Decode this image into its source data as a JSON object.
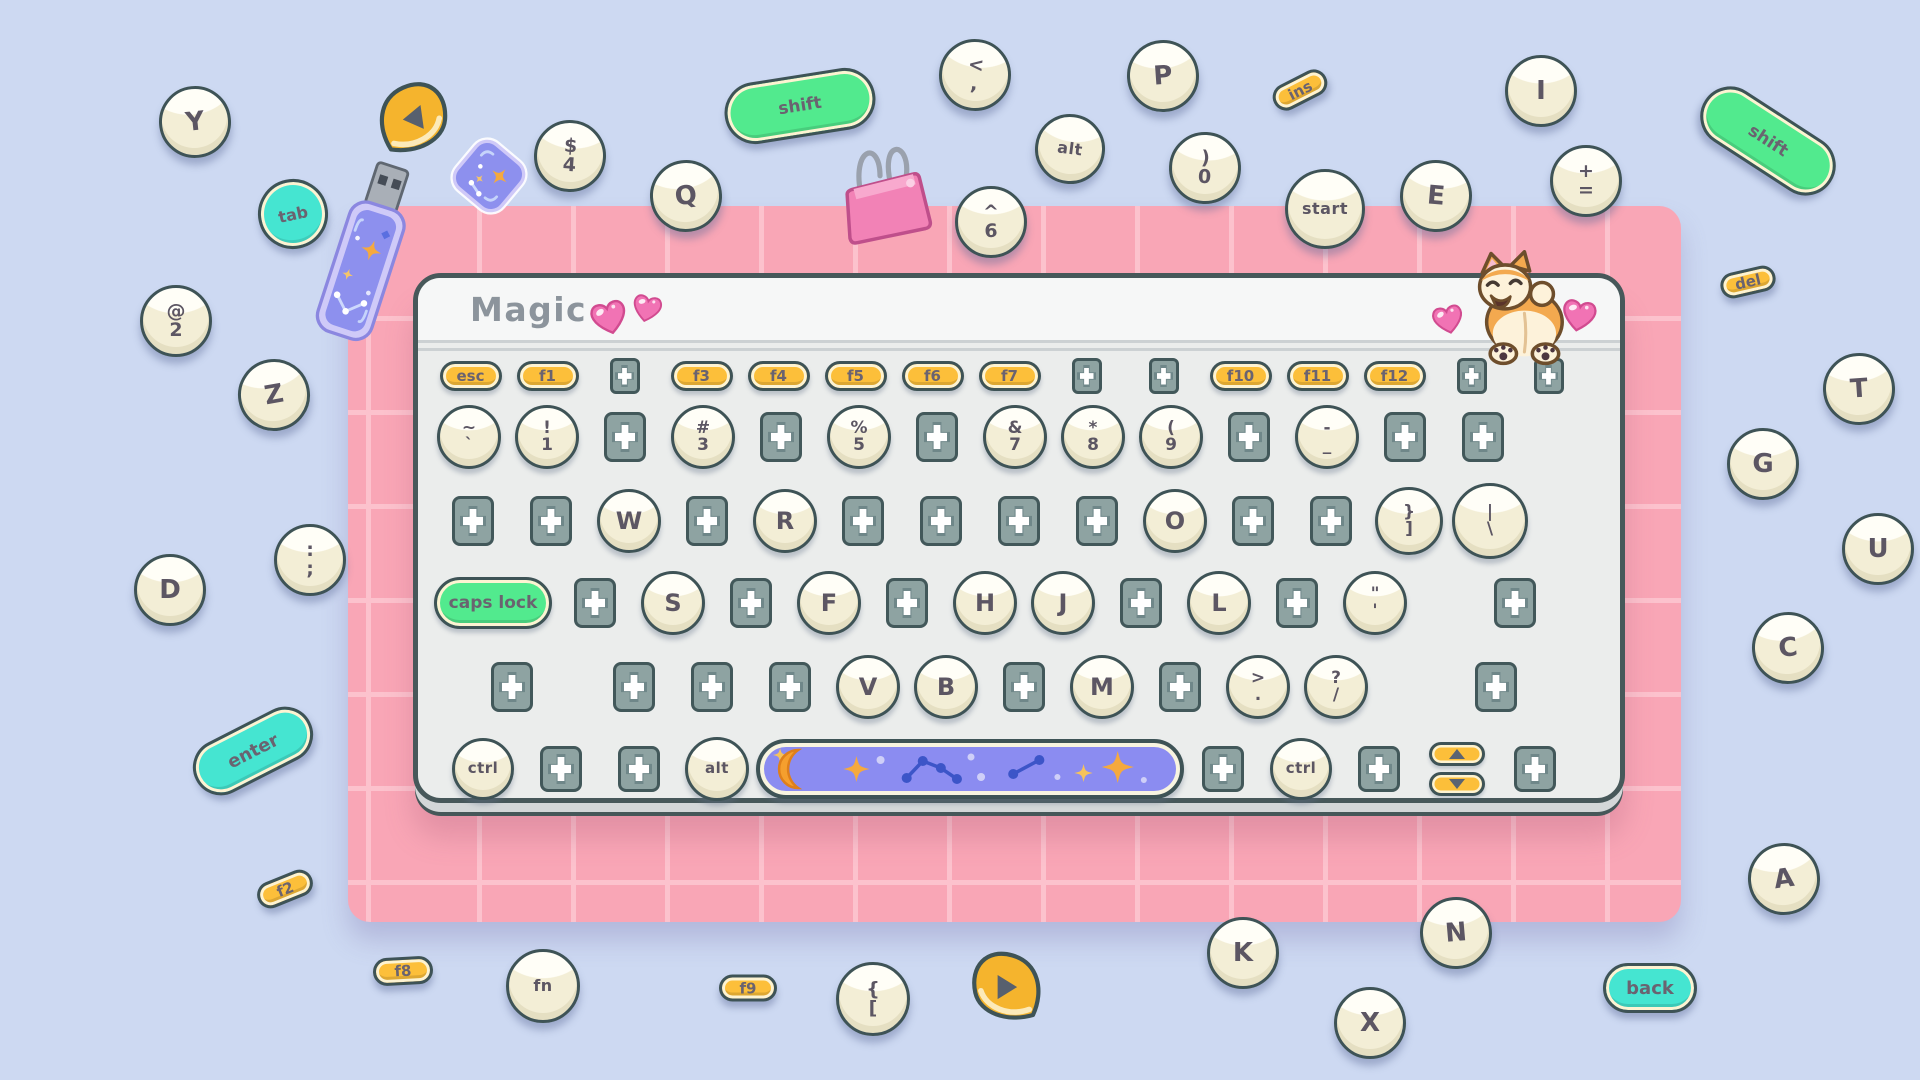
{
  "theme": {
    "background": "#cdd9f2",
    "mat": "#f9a6b6",
    "mat_grid": "#fcc2cd",
    "keyboard_body": "#ebedec",
    "keyboard_header": "#f6f7f7",
    "keyboard_border": "#47585a",
    "key_cream": "#fdfbee",
    "key_text": "#5c5663",
    "slot_fill": "#8ea3a2",
    "slot_border": "#42585a",
    "accent_yellow": "#fcbf3a",
    "accent_green": "#52ea8e",
    "accent_teal": "#45e5d1",
    "space_purple": "#8b8cf1",
    "heart_pink": "#f173b4",
    "corgi_orange": "#f3a94f"
  },
  "keyboard": {
    "title": "Magic",
    "rows": [
      {
        "name": "function",
        "top": 80,
        "left": 14,
        "cell": 77,
        "h": 36,
        "items": [
          {
            "k": "fpill",
            "l": "esc"
          },
          {
            "k": "fpill",
            "l": "f1"
          },
          {
            "k": "slot",
            "v": "sm"
          },
          {
            "k": "fpill",
            "l": "f3"
          },
          {
            "k": "fpill",
            "l": "f4"
          },
          {
            "k": "fpill",
            "l": "f5"
          },
          {
            "k": "fpill",
            "l": "f6"
          },
          {
            "k": "fpill",
            "l": "f7"
          },
          {
            "k": "slot",
            "v": "sm"
          },
          {
            "k": "slot",
            "v": "sm"
          },
          {
            "k": "fpill",
            "l": "f10"
          },
          {
            "k": "fpill",
            "l": "f11"
          },
          {
            "k": "fpill",
            "l": "f12"
          },
          {
            "k": "slot",
            "v": "sm"
          },
          {
            "k": "slot",
            "v": "sm"
          }
        ]
      },
      {
        "name": "number",
        "top": 124,
        "left": 12,
        "cell": 78,
        "h": 70,
        "items": [
          {
            "k": "key2",
            "l": "~",
            "l2": "`"
          },
          {
            "k": "key2",
            "l": "!",
            "l2": "1"
          },
          {
            "k": "slot"
          },
          {
            "k": "key2",
            "l": "#",
            "l2": "3"
          },
          {
            "k": "slot"
          },
          {
            "k": "key2",
            "l": "%",
            "l2": "5"
          },
          {
            "k": "slot"
          },
          {
            "k": "key2",
            "l": "&",
            "l2": "7"
          },
          {
            "k": "key2",
            "l": "*",
            "l2": "8"
          },
          {
            "k": "key2",
            "l": "(",
            "l2": "9"
          },
          {
            "k": "slot"
          },
          {
            "k": "key2",
            "l": "-",
            "l2": "_"
          },
          {
            "k": "slot"
          },
          {
            "k": "slot"
          }
        ]
      },
      {
        "name": "upper",
        "top": 207,
        "left": 16,
        "cell": 78,
        "h": 72,
        "items": [
          {
            "k": "slot"
          },
          {
            "k": "slot"
          },
          {
            "k": "key",
            "l": "W"
          },
          {
            "k": "slot"
          },
          {
            "k": "key",
            "l": "R"
          },
          {
            "k": "slot"
          },
          {
            "k": "slot"
          },
          {
            "k": "slot"
          },
          {
            "k": "slot"
          },
          {
            "k": "key",
            "l": "O"
          },
          {
            "k": "slot"
          },
          {
            "k": "slot"
          },
          {
            "k": "key2",
            "l": "}",
            "l2": "]",
            "size": 68
          },
          {
            "k": "key2",
            "l": "|",
            "l2": "\\",
            "w": 84,
            "size": 76
          }
        ]
      },
      {
        "name": "home",
        "top": 289,
        "left": 12,
        "cell": 78,
        "h": 72,
        "items": [
          {
            "k": "gpill",
            "l": "caps lock",
            "w": 126,
            "pw": 118,
            "ph": 52
          },
          {
            "k": "slot"
          },
          {
            "k": "key",
            "l": "S"
          },
          {
            "k": "slot"
          },
          {
            "k": "key",
            "l": "F"
          },
          {
            "k": "slot"
          },
          {
            "k": "key",
            "l": "H"
          },
          {
            "k": "key",
            "l": "J"
          },
          {
            "k": "slot"
          },
          {
            "k": "key",
            "l": "L"
          },
          {
            "k": "slot"
          },
          {
            "k": "key2",
            "l": "\"",
            "l2": "'"
          },
          {
            "k": "slot",
            "ml": 62
          }
        ]
      },
      {
        "name": "lower",
        "top": 373,
        "left": 55,
        "cell": 78,
        "h": 72,
        "items": [
          {
            "k": "slot"
          },
          {
            "k": "slot",
            "ml": 44
          },
          {
            "k": "slot"
          },
          {
            "k": "slot"
          },
          {
            "k": "key",
            "l": "V"
          },
          {
            "k": "key",
            "l": "B"
          },
          {
            "k": "slot"
          },
          {
            "k": "key",
            "l": "M"
          },
          {
            "k": "slot"
          },
          {
            "k": "key2",
            "l": ">",
            "l2": "."
          },
          {
            "k": "key2",
            "l": "?",
            "l2": "/"
          },
          {
            "k": "slot",
            "ml": 82
          }
        ]
      },
      {
        "name": "modifier",
        "top": 456,
        "left": 26,
        "cell": 78,
        "h": 70,
        "items": [
          {
            "k": "key",
            "l": "ctrl",
            "word": true,
            "size": 62
          },
          {
            "k": "slot",
            "v": "md"
          },
          {
            "k": "slot",
            "v": "md"
          },
          {
            "k": "key",
            "l": "alt",
            "word": true,
            "size": 64
          },
          {
            "k": "space",
            "w": 428
          },
          {
            "k": "slot",
            "v": "md"
          },
          {
            "k": "key",
            "l": "ctrl",
            "word": true,
            "size": 62
          },
          {
            "k": "slot",
            "v": "md"
          },
          {
            "k": "arrows"
          },
          {
            "k": "slot",
            "v": "md"
          }
        ]
      }
    ]
  },
  "scattered": [
    {
      "name": "key-y",
      "k": "key",
      "l": "Y",
      "x": 195,
      "y": 122,
      "rot": -6
    },
    {
      "name": "key-tab",
      "k": "tkey",
      "l": "tab",
      "x": 293,
      "y": 214,
      "rot": -12
    },
    {
      "name": "media-key-left",
      "k": "media",
      "x": 414,
      "y": 119,
      "rot": -8
    },
    {
      "name": "key-4",
      "k": "key2",
      "l": "$",
      "l2": "4",
      "x": 570,
      "y": 156,
      "rot": 4
    },
    {
      "name": "key-q",
      "k": "key",
      "l": "Q",
      "x": 686,
      "y": 196,
      "rot": -8
    },
    {
      "name": "key-shift-left",
      "k": "gpill",
      "l": "shift",
      "x": 800,
      "y": 106,
      "rot": -9,
      "w": 152,
      "h": 62
    },
    {
      "name": "key-comma",
      "k": "key2",
      "l": "<",
      "l2": ",",
      "x": 975,
      "y": 75,
      "rot": 6
    },
    {
      "name": "key-6",
      "k": "key2",
      "l": "^",
      "l2": "6",
      "x": 991,
      "y": 222,
      "rot": 0
    },
    {
      "name": "key-alt",
      "k": "key",
      "l": "alt",
      "word": true,
      "x": 1070,
      "y": 149,
      "rot": 7,
      "size": 70
    },
    {
      "name": "key-p",
      "k": "key",
      "l": "P",
      "x": 1163,
      "y": 76,
      "rot": -4
    },
    {
      "name": "key-ins",
      "k": "fpill",
      "l": "ins",
      "x": 1300,
      "y": 90,
      "rot": -27,
      "w": 58,
      "h": 27
    },
    {
      "name": "key-0",
      "k": "key2",
      "l": ")",
      "l2": "0",
      "x": 1205,
      "y": 168,
      "rot": 3
    },
    {
      "name": "key-start",
      "k": "key",
      "l": "start",
      "word": true,
      "x": 1325,
      "y": 209,
      "rot": 0,
      "size": 80
    },
    {
      "name": "key-e",
      "k": "key",
      "l": "E",
      "x": 1436,
      "y": 196,
      "rot": 5
    },
    {
      "name": "key-i",
      "k": "key",
      "l": "I",
      "x": 1541,
      "y": 91,
      "rot": 0
    },
    {
      "name": "key-equals",
      "k": "key2",
      "l": "+",
      "l2": "=",
      "x": 1586,
      "y": 181,
      "rot": 0
    },
    {
      "name": "key-shift-right",
      "k": "gpill",
      "l": "shift",
      "x": 1768,
      "y": 141,
      "rot": 33,
      "w": 150,
      "h": 60
    },
    {
      "name": "key-del",
      "k": "fpill",
      "l": "del",
      "x": 1748,
      "y": 282,
      "rot": -13,
      "w": 56,
      "h": 26
    },
    {
      "name": "key-t",
      "k": "key",
      "l": "T",
      "x": 1859,
      "y": 389,
      "rot": -4
    },
    {
      "name": "key-g",
      "k": "key",
      "l": "G",
      "x": 1763,
      "y": 464,
      "rot": 0
    },
    {
      "name": "key-u",
      "k": "key",
      "l": "U",
      "x": 1878,
      "y": 549,
      "rot": 0
    },
    {
      "name": "key-c",
      "k": "key",
      "l": "C",
      "x": 1788,
      "y": 648,
      "rot": -6
    },
    {
      "name": "key-a",
      "k": "key",
      "l": "A",
      "x": 1784,
      "y": 879,
      "rot": -8
    },
    {
      "name": "key-2",
      "k": "key2",
      "l": "@",
      "l2": "2",
      "x": 176,
      "y": 321,
      "rot": 0
    },
    {
      "name": "key-z",
      "k": "key",
      "l": "Z",
      "x": 274,
      "y": 395,
      "rot": -10
    },
    {
      "name": "key-d",
      "k": "key",
      "l": "D",
      "x": 170,
      "y": 590,
      "rot": 0
    },
    {
      "name": "key-semicolon",
      "k": "key2",
      "l": ":",
      "l2": ";",
      "x": 310,
      "y": 560,
      "rot": 0
    },
    {
      "name": "key-enter",
      "k": "tpill",
      "l": "enter",
      "x": 253,
      "y": 751,
      "rot": -27,
      "w": 128,
      "h": 56
    },
    {
      "name": "key-f2",
      "k": "fpill",
      "l": "f2",
      "x": 285,
      "y": 889,
      "rot": -22,
      "w": 58,
      "h": 27
    },
    {
      "name": "key-f8",
      "k": "fpill",
      "l": "f8",
      "x": 403,
      "y": 971,
      "rot": -3,
      "w": 60,
      "h": 28
    },
    {
      "name": "key-fn",
      "k": "key",
      "l": "fn",
      "word": true,
      "x": 543,
      "y": 986,
      "rot": 0,
      "size": 74
    },
    {
      "name": "key-f9",
      "k": "fpill",
      "l": "f9",
      "x": 748,
      "y": 988,
      "rot": 0,
      "w": 58,
      "h": 27
    },
    {
      "name": "key-bracket-open",
      "k": "key2",
      "l": "{",
      "l2": "[",
      "x": 873,
      "y": 999,
      "rot": 0,
      "size": 74
    },
    {
      "name": "media-key-right",
      "k": "media",
      "x": 1006,
      "y": 988,
      "rot": 0,
      "flip": true
    },
    {
      "name": "key-k",
      "k": "key",
      "l": "K",
      "x": 1243,
      "y": 953,
      "rot": 0
    },
    {
      "name": "key-n",
      "k": "key",
      "l": "N",
      "x": 1456,
      "y": 933,
      "rot": -5
    },
    {
      "name": "key-x",
      "k": "key",
      "l": "X",
      "x": 1370,
      "y": 1023,
      "rot": 0
    },
    {
      "name": "key-back",
      "k": "tpill",
      "l": "back",
      "x": 1650,
      "y": 988,
      "rot": 0,
      "w": 94,
      "h": 50
    }
  ],
  "props": [
    {
      "name": "usb-drive",
      "k": "usb",
      "x": 367,
      "y": 253,
      "rot": 18
    },
    {
      "name": "sparkle-sticker",
      "k": "sticker",
      "x": 489,
      "y": 176,
      "rot": 40
    },
    {
      "name": "binder-clip",
      "k": "clip",
      "x": 886,
      "y": 183,
      "rot": -6
    },
    {
      "name": "corgi-sticker",
      "k": "corgi",
      "x": 1513,
      "y": 308,
      "rot": 0
    },
    {
      "name": "heart-title-1",
      "k": "heart",
      "x": 609,
      "y": 317,
      "rot": -14,
      "s": 42
    },
    {
      "name": "heart-title-2",
      "k": "heart",
      "x": 647,
      "y": 308,
      "rot": 12,
      "s": 34
    },
    {
      "name": "heart-corgi-left",
      "k": "heart",
      "x": 1448,
      "y": 319,
      "rot": -12,
      "s": 36
    },
    {
      "name": "heart-corgi-right",
      "k": "heart",
      "x": 1579,
      "y": 315,
      "rot": 10,
      "s": 40
    }
  ]
}
